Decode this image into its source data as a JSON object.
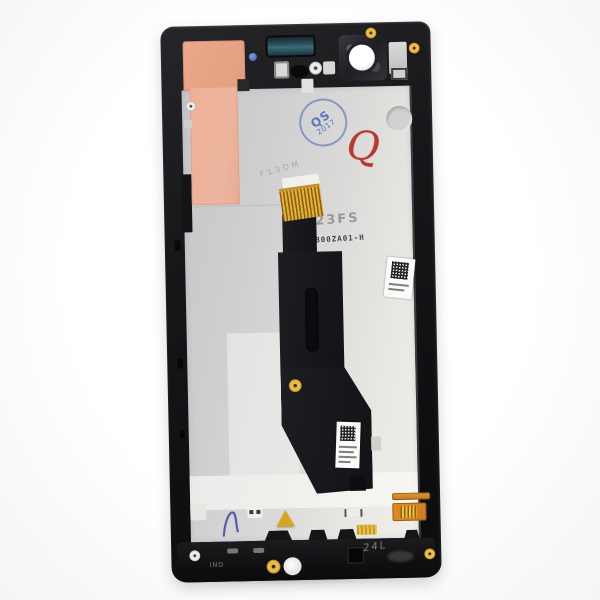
{
  "scene": {
    "description": "Product photo of a smartphone LCD screen assembly with frame, rear view, showing chassis backplate, flex cable and service markings",
    "background_color": "#fbfbfa"
  },
  "device": {
    "frame_color": "#17171a",
    "backplate_color": "#d6d5d4",
    "copper_sticker_color": "#ecab92",
    "flex_cable_color": "#17181c",
    "gold_contact_color": "#e2b13a",
    "mesh_color": "#2c525e",
    "accent_stamp_blue": "#5d76b8",
    "accent_mark_red": "#b8392f"
  },
  "markings": {
    "qs_stamp": {
      "line1": "QS",
      "line2": "2017",
      "color": "#5d76b8"
    },
    "handwritten_q": {
      "text": "Q",
      "color": "#b8392f"
    },
    "etched_code": "23FS",
    "part_number": "1B00ZA01-H",
    "faint_etch": "F13DM",
    "ind_label": "IND",
    "scribble": "24L"
  }
}
